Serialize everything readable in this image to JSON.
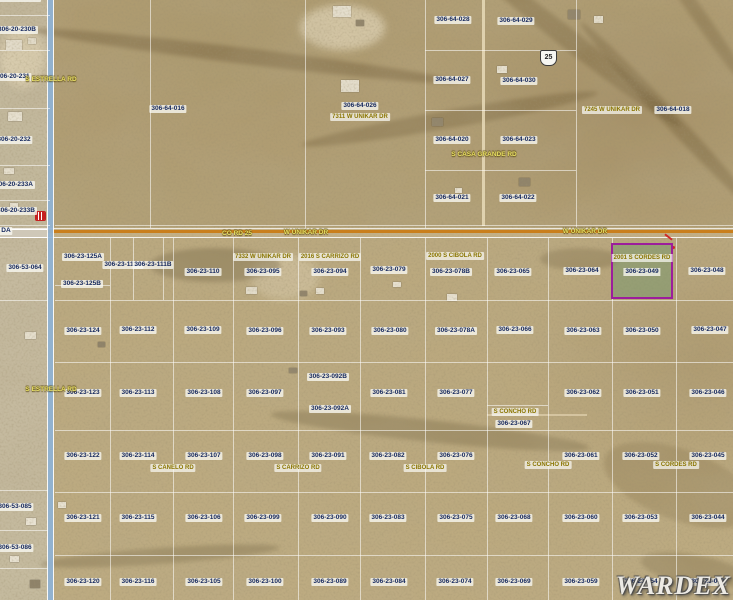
{
  "map": {
    "watermark": "WARDEX",
    "shield": {
      "label": "25"
    },
    "highlight": {
      "address": "2001 S CORDES RD",
      "parcel": "306-23-049"
    },
    "colors": {
      "highlight_border": "#9c1d9c",
      "highlight_fill": "#6e9664",
      "road_orange": "#c97f1d",
      "road_blue": "#8fb3d6",
      "parcel_text": "#13265c",
      "address_text": "#8a7500",
      "road_text": "#e8df63"
    },
    "parcel_labels": [
      {
        "t": "306-20-230A",
        "x": 20,
        "y": -2
      },
      {
        "t": "306-20-230B",
        "x": 17,
        "y": 30
      },
      {
        "t": "306-20-231",
        "x": 13,
        "y": 77
      },
      {
        "t": "306-20-232",
        "x": 14,
        "y": 140
      },
      {
        "t": "306-20-233A",
        "x": 14,
        "y": 185
      },
      {
        "t": "306-20-233B",
        "x": 16,
        "y": 211
      },
      {
        "t": "DA",
        "x": 6,
        "y": 231
      },
      {
        "t": "306-64-016",
        "x": 168,
        "y": 109
      },
      {
        "t": "306-64-026",
        "x": 360,
        "y": 106
      },
      {
        "t": "306-64-028",
        "x": 453,
        "y": 20
      },
      {
        "t": "306-64-029",
        "x": 516,
        "y": 21
      },
      {
        "t": "306-64-027",
        "x": 452,
        "y": 80
      },
      {
        "t": "306-64-030",
        "x": 519,
        "y": 81
      },
      {
        "t": "306-64-020",
        "x": 452,
        "y": 140
      },
      {
        "t": "306-64-023",
        "x": 519,
        "y": 140
      },
      {
        "t": "306-64-021",
        "x": 452,
        "y": 198
      },
      {
        "t": "306-64-022",
        "x": 518,
        "y": 198
      },
      {
        "t": "306-64-018",
        "x": 673,
        "y": 110
      },
      {
        "t": "306-53-064",
        "x": 25,
        "y": 268,
        "v": true
      },
      {
        "t": "306-23-111A",
        "x": 123,
        "y": 265,
        "v": true
      },
      {
        "t": "306-23-111B",
        "x": 153,
        "y": 265,
        "v": true
      },
      {
        "t": "306-23-125A",
        "x": 83,
        "y": 257
      },
      {
        "t": "306-23-125B",
        "x": 82,
        "y": 284
      },
      {
        "t": "306-23-110",
        "x": 203,
        "y": 272
      },
      {
        "t": "306-23-095",
        "x": 263,
        "y": 272
      },
      {
        "t": "306-23-094",
        "x": 330,
        "y": 272
      },
      {
        "t": "306-23-079",
        "x": 389,
        "y": 270
      },
      {
        "t": "306-23-078B",
        "x": 451,
        "y": 272
      },
      {
        "t": "306-23-065",
        "x": 513,
        "y": 272
      },
      {
        "t": "306-23-064",
        "x": 582,
        "y": 271
      },
      {
        "t": "306-23-048",
        "x": 707,
        "y": 271
      },
      {
        "t": "306-23-124",
        "x": 83,
        "y": 331
      },
      {
        "t": "306-23-112",
        "x": 138,
        "y": 330
      },
      {
        "t": "306-23-109",
        "x": 203,
        "y": 330
      },
      {
        "t": "306-23-096",
        "x": 265,
        "y": 331
      },
      {
        "t": "306-23-093",
        "x": 328,
        "y": 331
      },
      {
        "t": "306-23-080",
        "x": 390,
        "y": 331
      },
      {
        "t": "306-23-078A",
        "x": 456,
        "y": 331
      },
      {
        "t": "306-23-066",
        "x": 515,
        "y": 330
      },
      {
        "t": "306-23-063",
        "x": 583,
        "y": 331
      },
      {
        "t": "306-23-050",
        "x": 642,
        "y": 331
      },
      {
        "t": "306-23-047",
        "x": 710,
        "y": 330
      },
      {
        "t": "306-23-123",
        "x": 83,
        "y": 393
      },
      {
        "t": "306-23-113",
        "x": 138,
        "y": 393
      },
      {
        "t": "306-23-108",
        "x": 204,
        "y": 393
      },
      {
        "t": "306-23-097",
        "x": 265,
        "y": 393
      },
      {
        "t": "306-23-092B",
        "x": 328,
        "y": 377
      },
      {
        "t": "306-23-092A",
        "x": 330,
        "y": 409
      },
      {
        "t": "306-23-081",
        "x": 389,
        "y": 393
      },
      {
        "t": "306-23-077",
        "x": 456,
        "y": 393
      },
      {
        "t": "306-23-067",
        "x": 514,
        "y": 424
      },
      {
        "t": "306-23-062",
        "x": 583,
        "y": 393
      },
      {
        "t": "306-23-051",
        "x": 642,
        "y": 393
      },
      {
        "t": "306-23-046",
        "x": 708,
        "y": 393
      },
      {
        "t": "306-23-122",
        "x": 83,
        "y": 456
      },
      {
        "t": "306-23-114",
        "x": 138,
        "y": 456
      },
      {
        "t": "306-23-107",
        "x": 204,
        "y": 456
      },
      {
        "t": "306-23-098",
        "x": 265,
        "y": 456
      },
      {
        "t": "306-23-091",
        "x": 328,
        "y": 456
      },
      {
        "t": "306-23-082",
        "x": 388,
        "y": 456
      },
      {
        "t": "306-23-076",
        "x": 456,
        "y": 456
      },
      {
        "t": "306-23-061",
        "x": 581,
        "y": 456
      },
      {
        "t": "306-23-052",
        "x": 641,
        "y": 456
      },
      {
        "t": "306-23-045",
        "x": 708,
        "y": 456
      },
      {
        "t": "306-53-085",
        "x": 15,
        "y": 507
      },
      {
        "t": "306-53-086",
        "x": 15,
        "y": 548
      },
      {
        "t": "306-23-121",
        "x": 83,
        "y": 518
      },
      {
        "t": "306-23-115",
        "x": 138,
        "y": 518
      },
      {
        "t": "306-23-106",
        "x": 204,
        "y": 518
      },
      {
        "t": "306-23-099",
        "x": 263,
        "y": 518
      },
      {
        "t": "306-23-090",
        "x": 330,
        "y": 518
      },
      {
        "t": "306-23-083",
        "x": 388,
        "y": 518
      },
      {
        "t": "306-23-075",
        "x": 456,
        "y": 518
      },
      {
        "t": "306-23-068",
        "x": 514,
        "y": 518
      },
      {
        "t": "306-23-060",
        "x": 581,
        "y": 518
      },
      {
        "t": "306-23-053",
        "x": 641,
        "y": 518
      },
      {
        "t": "306-23-044",
        "x": 708,
        "y": 518
      },
      {
        "t": "306-23-120",
        "x": 83,
        "y": 582
      },
      {
        "t": "306-23-116",
        "x": 138,
        "y": 582
      },
      {
        "t": "306-23-105",
        "x": 204,
        "y": 582
      },
      {
        "t": "306-23-100",
        "x": 265,
        "y": 582
      },
      {
        "t": "306-23-089",
        "x": 330,
        "y": 582
      },
      {
        "t": "306-23-084",
        "x": 389,
        "y": 582
      },
      {
        "t": "306-23-074",
        "x": 455,
        "y": 582
      },
      {
        "t": "306-23-069",
        "x": 514,
        "y": 582
      },
      {
        "t": "306-23-059",
        "x": 581,
        "y": 582
      },
      {
        "t": "306-23-054",
        "x": 641,
        "y": 582
      },
      {
        "t": "306-23-043",
        "x": 708,
        "y": 582
      }
    ],
    "address_labels": [
      {
        "t": "7311 W UNIKAR DR",
        "x": 360,
        "y": 117
      },
      {
        "t": "7245 W UNIKAR DR",
        "x": 612,
        "y": 110
      },
      {
        "t": "7332 W UNIKAR DR",
        "x": 263,
        "y": 257
      },
      {
        "t": "2016 S CARRIZO RD",
        "x": 330,
        "y": 257
      },
      {
        "t": "2000 S CIBOLA RD",
        "x": 455,
        "y": 256
      }
    ],
    "road_labels": [
      {
        "t": "W UNIKAR DR",
        "x": 306,
        "y": 233
      },
      {
        "t": "CO RD 25",
        "x": 237,
        "y": 234
      },
      {
        "t": "W UNIKAR DR",
        "x": 585,
        "y": 232
      },
      {
        "t": "S ESTRELLA RD",
        "x": 51,
        "y": 80,
        "v": true,
        "down": true
      },
      {
        "t": "S ESTRELLA RD",
        "x": 51,
        "y": 390,
        "v": true,
        "down": true
      },
      {
        "t": "S CASA GRANDE RD",
        "x": 484,
        "y": 155,
        "v": true,
        "down": true
      },
      {
        "t": "S CANELO RD",
        "x": 173,
        "y": 468,
        "v": true,
        "boxed": true
      },
      {
        "t": "S CARRIZO RD",
        "x": 298,
        "y": 468,
        "v": true,
        "boxed": true
      },
      {
        "t": "S CIBOLA RD",
        "x": 425,
        "y": 468,
        "v": true,
        "boxed": true
      },
      {
        "t": "S CONCHO RD",
        "x": 548,
        "y": 465,
        "v": true,
        "boxed": true
      },
      {
        "t": "S CORDES RD",
        "x": 676,
        "y": 465,
        "v": true,
        "boxed": true
      },
      {
        "t": "S CONCHO RD",
        "x": 515,
        "y": 412,
        "boxed": true
      }
    ]
  }
}
